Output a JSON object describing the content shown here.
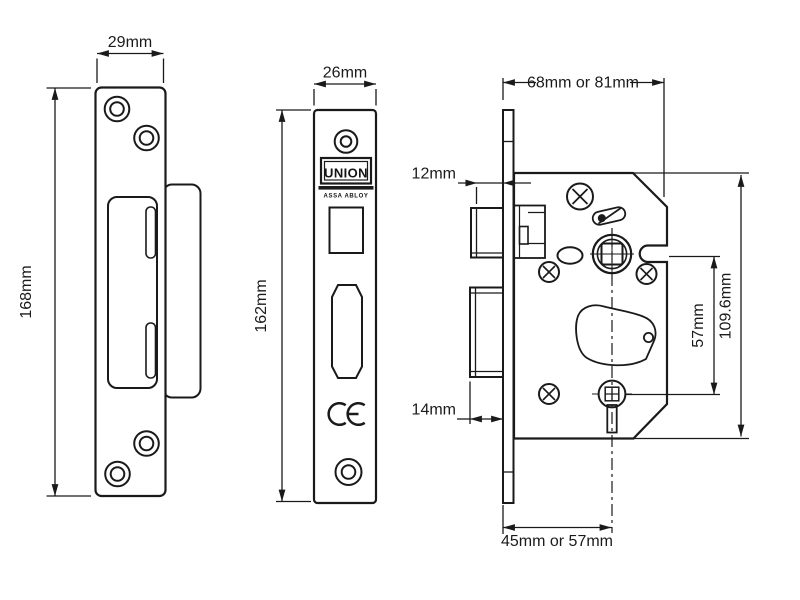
{
  "figures": {
    "strike_plate": {
      "width_label": "29mm",
      "height_label": "168mm"
    },
    "forend": {
      "width_label": "26mm",
      "height_label": "162mm",
      "brand": "UNION",
      "brand_sub": "ASSA ABLOY",
      "ce_mark": "CE"
    },
    "lock_case": {
      "case_width_label": "68mm or 81mm",
      "latch_projection_label": "12mm",
      "bolt_projection_label": "14mm",
      "backset_label": "45mm or 57mm",
      "centres_label": "57mm",
      "case_height_label": "109.6mm"
    }
  },
  "colors": {
    "line": "#1a1a1a",
    "background": "#ffffff"
  }
}
